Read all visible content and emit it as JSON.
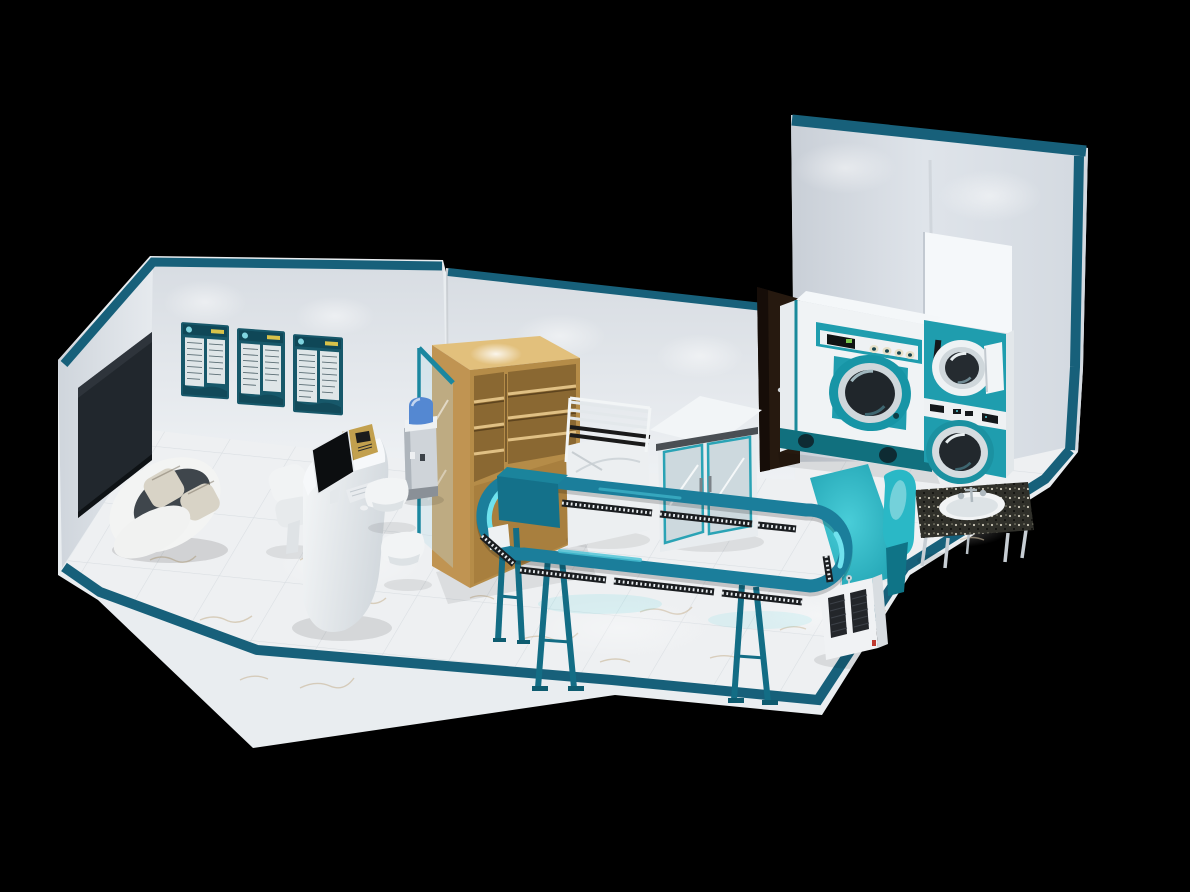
{
  "scene": {
    "type": "3d-interior-render",
    "subject": "laundry and dry-cleaning shop floor plan",
    "view": "isometric cutaway on black background"
  },
  "palette": {
    "background": "#000000",
    "slab_white": "#e9edf0",
    "wall": "#dde2e8",
    "wall_bright": "#f0f3f6",
    "edge_teal": "#17607a",
    "floor": "#eef0f2",
    "floor_line": "#d4d9de",
    "vein": "#c9b697",
    "tv_screen": "#21272d",
    "door_brown": "#26190f",
    "conveyor_teal": "#1b7e9b",
    "conveyor_glint": "#6fe2ee",
    "machine_teal": "#1f9dae",
    "machine_teal_dark": "#11707e",
    "ironing_teal": "#25b2c1",
    "wood": "#c09452",
    "wood_light": "#e2c07c",
    "wood_dark": "#8a6832",
    "granite": "#30302a",
    "sofa_seat": "#3f464c",
    "cushion": "#d8d3c6",
    "gold": "#c2a04e",
    "bottle_blue": "#5488d2",
    "chrome": "#d6dde2",
    "glass": "#bcd8e2",
    "hanger_dark": "#1a1d20"
  },
  "objects": {
    "tv": "Wall-mounted TV",
    "certificates": "Framed wall certificates",
    "sofa": "Lounge pod sofa",
    "reception_desk": "Reception counter",
    "monitor": "POS monitor",
    "cash_register": "Cash register",
    "guest_chair": "Guest chair",
    "stools": "Waiting stools",
    "water_dispenser": "Water dispenser",
    "glass_partition": "Glass partition",
    "storage_shelf": "Wooden storage shelving",
    "drying_rack": "Garment drying rack",
    "display_cabinet": "Glass-door cabinet",
    "back_door": "Back-room door",
    "dry_cleaning_machine": "Dry cleaning machine",
    "stacked_washer_dryer": "Stacked washer and dryer",
    "garment_conveyor": "Garment conveyor rail",
    "ironing_table": "Ironing table with buck",
    "sink_table": "Granite sink table"
  }
}
